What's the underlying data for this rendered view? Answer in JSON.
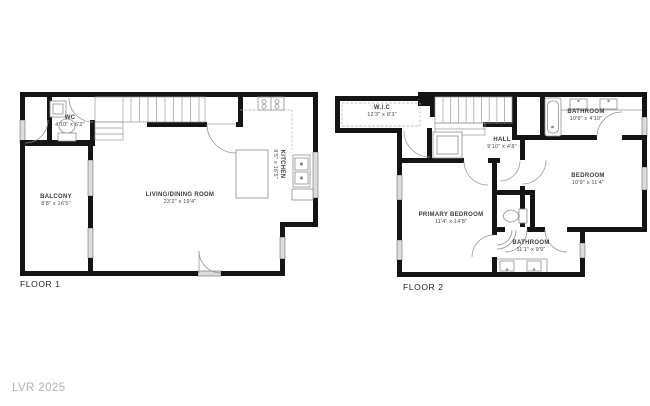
{
  "watermark": "LVR 2025",
  "floor1": {
    "label": "FLOOR 1",
    "rooms": {
      "wc": {
        "name": "WC",
        "dims": "4'10\" x 6'2\""
      },
      "balcony": {
        "name": "BALCONY",
        "dims": "8'8\" x 16'5\""
      },
      "living_dining": {
        "name": "LIVING/DINING ROOM",
        "dims": "23'2\" x 19'4\""
      },
      "kitchen": {
        "name": "KITCHEN",
        "dims": "9'5\" x 16'5\""
      }
    }
  },
  "floor2": {
    "label": "FLOOR 2",
    "rooms": {
      "wic": {
        "name": "W.I.C",
        "dims": "12'3\" x 8'3\""
      },
      "hall": {
        "name": "HALL",
        "dims": "9'10\" x 4'8\""
      },
      "bathroom_top": {
        "name": "BATHROOM",
        "dims": "10'9\" x 4'10\""
      },
      "bedroom": {
        "name": "BEDROOM",
        "dims": "10'9\" x 11'4\""
      },
      "primary_bedroom": {
        "name": "PRIMARY BEDROOM",
        "dims": "11'4\" x 14'8\""
      },
      "bathroom_bottom": {
        "name": "BATHROOM",
        "dims": "11'1\" x 9'9\""
      }
    }
  },
  "colors": {
    "wall": "#141414",
    "window": "#dcdcdc",
    "fixture_line": "#8f8f8f",
    "label_text": "#3c3c3c",
    "watermark_text": "#b2b5b8"
  }
}
